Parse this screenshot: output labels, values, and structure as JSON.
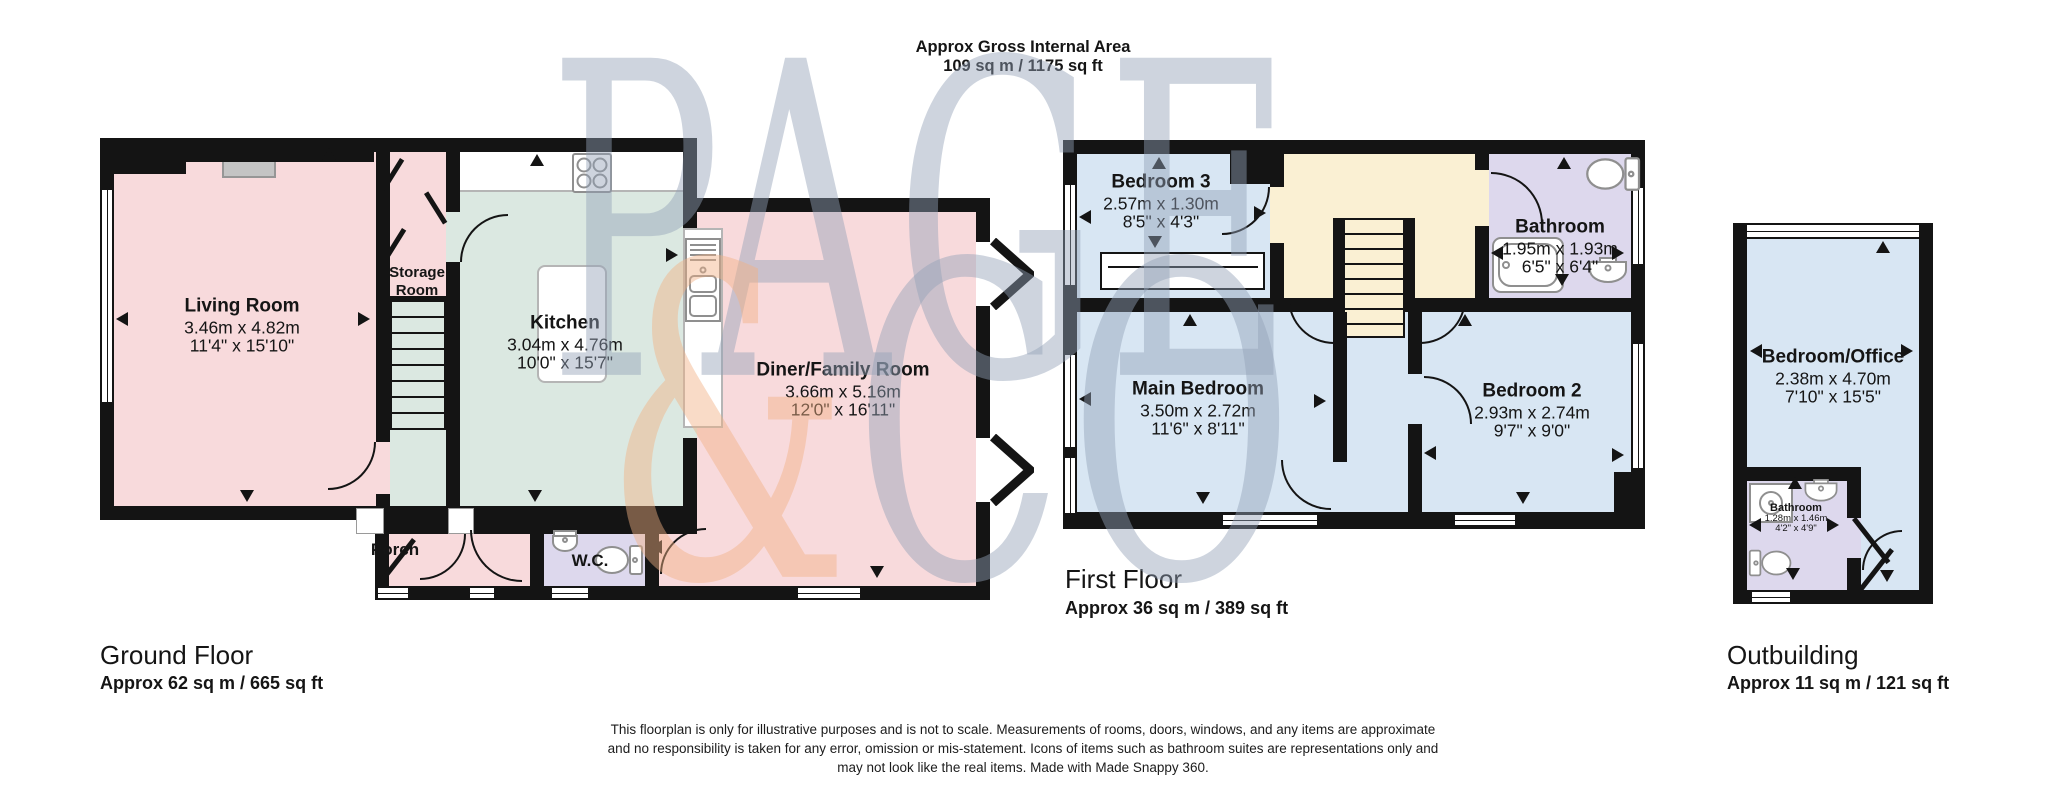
{
  "colors": {
    "wall": "#141414",
    "pink": "#f8dadc",
    "mint": "#dbe8e1",
    "blue": "#d8e6f3",
    "lav": "#ddd8ed",
    "cream": "#faf0d3",
    "wmgray": "#93a2b8",
    "wmorange": "#f2b184",
    "fixture": "#8f8f8f",
    "counterline": "#b5b5b5",
    "hearth": "#c4c4c4"
  },
  "title": {
    "line1": "Approx Gross Internal Area",
    "line2": "109 sq m / 1175 sq ft"
  },
  "watermark": {
    "word": "PAGE",
    "amp": "&",
    "co": "CO"
  },
  "ground": {
    "label": "Ground Floor",
    "area": "Approx 62 sq m / 665 sq ft",
    "living": {
      "name": "Living Room",
      "metric": "3.46m x 4.82m",
      "imperial": "11'4\" x 15'10\""
    },
    "storage": {
      "name": "Storage Room"
    },
    "kitchen": {
      "name": "Kitchen",
      "metric": "3.04m x 4.76m",
      "imperial": "10'0\" x 15'7\""
    },
    "diner": {
      "name": "Diner/Family Room",
      "metric": "3.66m x 5.16m",
      "imperial": "12'0\" x 16'11\""
    },
    "porch": {
      "name": "Porch"
    },
    "wc": {
      "name": "W.C."
    }
  },
  "first": {
    "label": "First Floor",
    "area": "Approx 36 sq m / 389 sq ft",
    "bedroom3": {
      "name": "Bedroom 3",
      "metric": "2.57m x 1.30m",
      "imperial": "8'5\" x 4'3\""
    },
    "bathroom": {
      "name": "Bathroom",
      "metric": "1.95m x 1.93m",
      "imperial": "6'5\" x 6'4\""
    },
    "main_bedroom": {
      "name": "Main Bedroom",
      "metric": "3.50m x 2.72m",
      "imperial": "11'6\" x 8'11\""
    },
    "bedroom2": {
      "name": "Bedroom 2",
      "metric": "2.93m x 2.74m",
      "imperial": "9'7\" x 9'0\""
    }
  },
  "outbuilding": {
    "label": "Outbuilding",
    "area": "Approx 11 sq m / 121 sq ft",
    "office": {
      "name": "Bedroom/Office",
      "metric": "2.38m x 4.70m",
      "imperial": "7'10\" x 15'5\""
    },
    "bathroom": {
      "name": "Bathroom",
      "metric": "1.28m x 1.46m",
      "imperial": "4'2\" x 4'9\""
    }
  },
  "disclaimer": {
    "line1": "This floorplan is only for illustrative purposes and is not to scale. Measurements of rooms, doors, windows, and any items are approximate",
    "line2": "and no responsibility is taken for any error, omission or mis-statement. Icons of items such as bathroom suites are representations only and",
    "line3": "may not look like the real items. Made with Made Snappy 360."
  }
}
